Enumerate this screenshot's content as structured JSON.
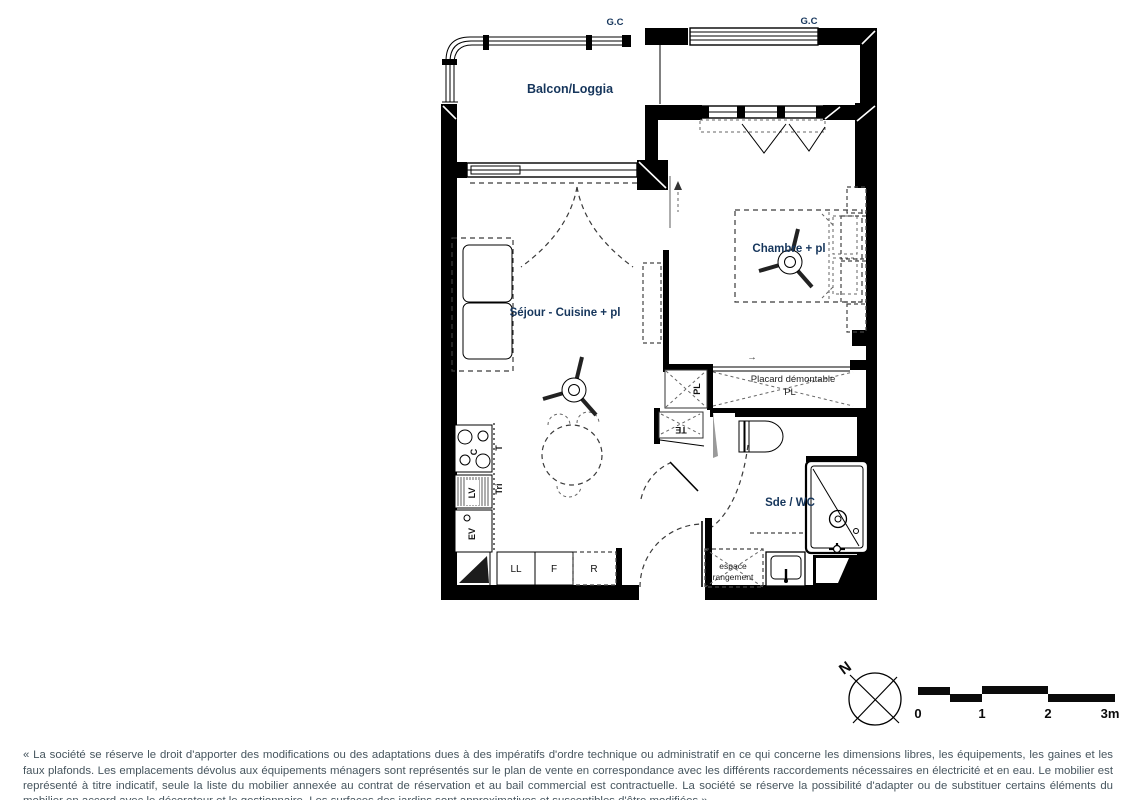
{
  "plan": {
    "labels": {
      "gc": "G.C",
      "balcony": "Balcon/Loggia",
      "bedroom": "Chambre + pl",
      "living": "Séjour - Cuisine + pl",
      "bathroom": "Sde / WC",
      "placard_line1": "Placard démontable",
      "placard_line2": "PL",
      "pl_small": "PL",
      "te_panel": "TE",
      "storage_line1": "espace",
      "storage_line2": "rangement",
      "washer": "LL",
      "fridge": "F",
      "storage_r": "R",
      "sink": "EV",
      "dishwasher": "LV",
      "cooktop": "C",
      "worktop": "T",
      "tri": "Tri",
      "arrow_right": "→",
      "arrow_left": "←"
    },
    "compass": {
      "north": "N"
    },
    "scalebar": {
      "ticks": [
        "0",
        "1",
        "2",
        "3m"
      ]
    },
    "colors": {
      "label_navy": "#16365c",
      "line_black": "#000000",
      "footer_text": "#46555e"
    }
  },
  "footer": {
    "disclaimer": "« La société se réserve le droit d'apporter des modifications ou des adaptations dues à des impératifs d'ordre technique ou administratif en ce qui concerne les dimensions libres, les équipements, les gaines et les faux plafonds. Les emplacements dévolus aux équipements ménagers sont représentés sur le plan de vente en correspondance avec les différents raccordements nécessaires en électricité et en eau. Le mobilier est représenté à titre indicatif, seule la liste du mobilier annexée au contrat de réservation et au bail commercial est contractuelle. La société se réserve la possibilité d'adapter ou de substituer certains éléments du mobilier en accord avec le décorateur et le gestionnaire. Les surfaces des jardins sont approximatives et susceptibles d'être modifiées »"
  }
}
